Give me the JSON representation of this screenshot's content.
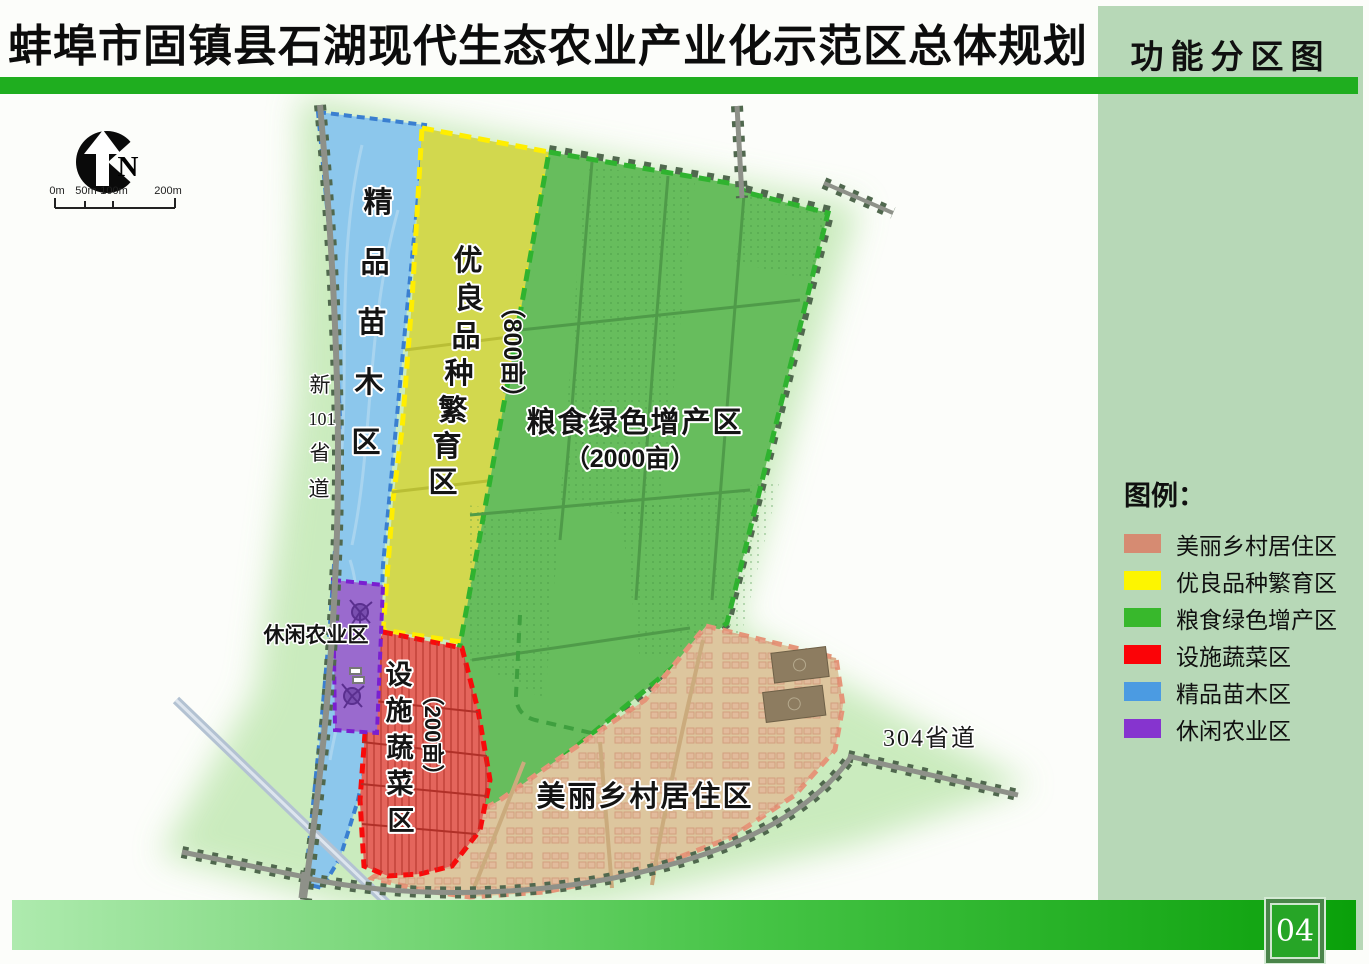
{
  "header": {
    "title": "蚌埠市固镇县石湖现代生态农业产业化示范区总体规划"
  },
  "sidebar": {
    "title": "功能分区图",
    "legend": {
      "title": "图例：",
      "items": [
        {
          "label": "美丽乡村居住区",
          "color": "#d68b72"
        },
        {
          "label": "优良品种繁育区",
          "color": "#fdf500"
        },
        {
          "label": "粮食绿色增产区",
          "color": "#38b82c"
        },
        {
          "label": "设施蔬菜区",
          "color": "#fb0307"
        },
        {
          "label": "精品苗木区",
          "color": "#4b9be2"
        },
        {
          "label": "休闲农业区",
          "color": "#8634cf"
        }
      ]
    }
  },
  "map": {
    "compass_label": "N",
    "scalebar": {
      "ticks": [
        "0m",
        "50m",
        "100m",
        "200m"
      ]
    },
    "roads": {
      "provincial101": {
        "chars": [
          "新",
          "101",
          "省",
          "道"
        ]
      },
      "provincial304": {
        "label": "304省道"
      }
    },
    "zones": {
      "nursery": {
        "name": "精品苗木区",
        "chars": [
          "精",
          "品",
          "苗",
          "木",
          "区"
        ]
      },
      "seed": {
        "name": "优良品种繁育区",
        "chars": [
          "优",
          "良",
          "品",
          "种",
          "繁",
          "育",
          "区"
        ],
        "area": "（800亩）"
      },
      "grain": {
        "label": "粮食绿色增产区",
        "area": "（2000亩）"
      },
      "vegetable": {
        "name": "设施蔬菜区",
        "chars": [
          "设",
          "施",
          "蔬",
          "菜",
          "区"
        ],
        "area": "（200亩）"
      },
      "leisure": {
        "label": "休闲农业区"
      },
      "village": {
        "label": "美丽乡村居住区"
      }
    }
  },
  "footer": {
    "page_number": "04"
  }
}
